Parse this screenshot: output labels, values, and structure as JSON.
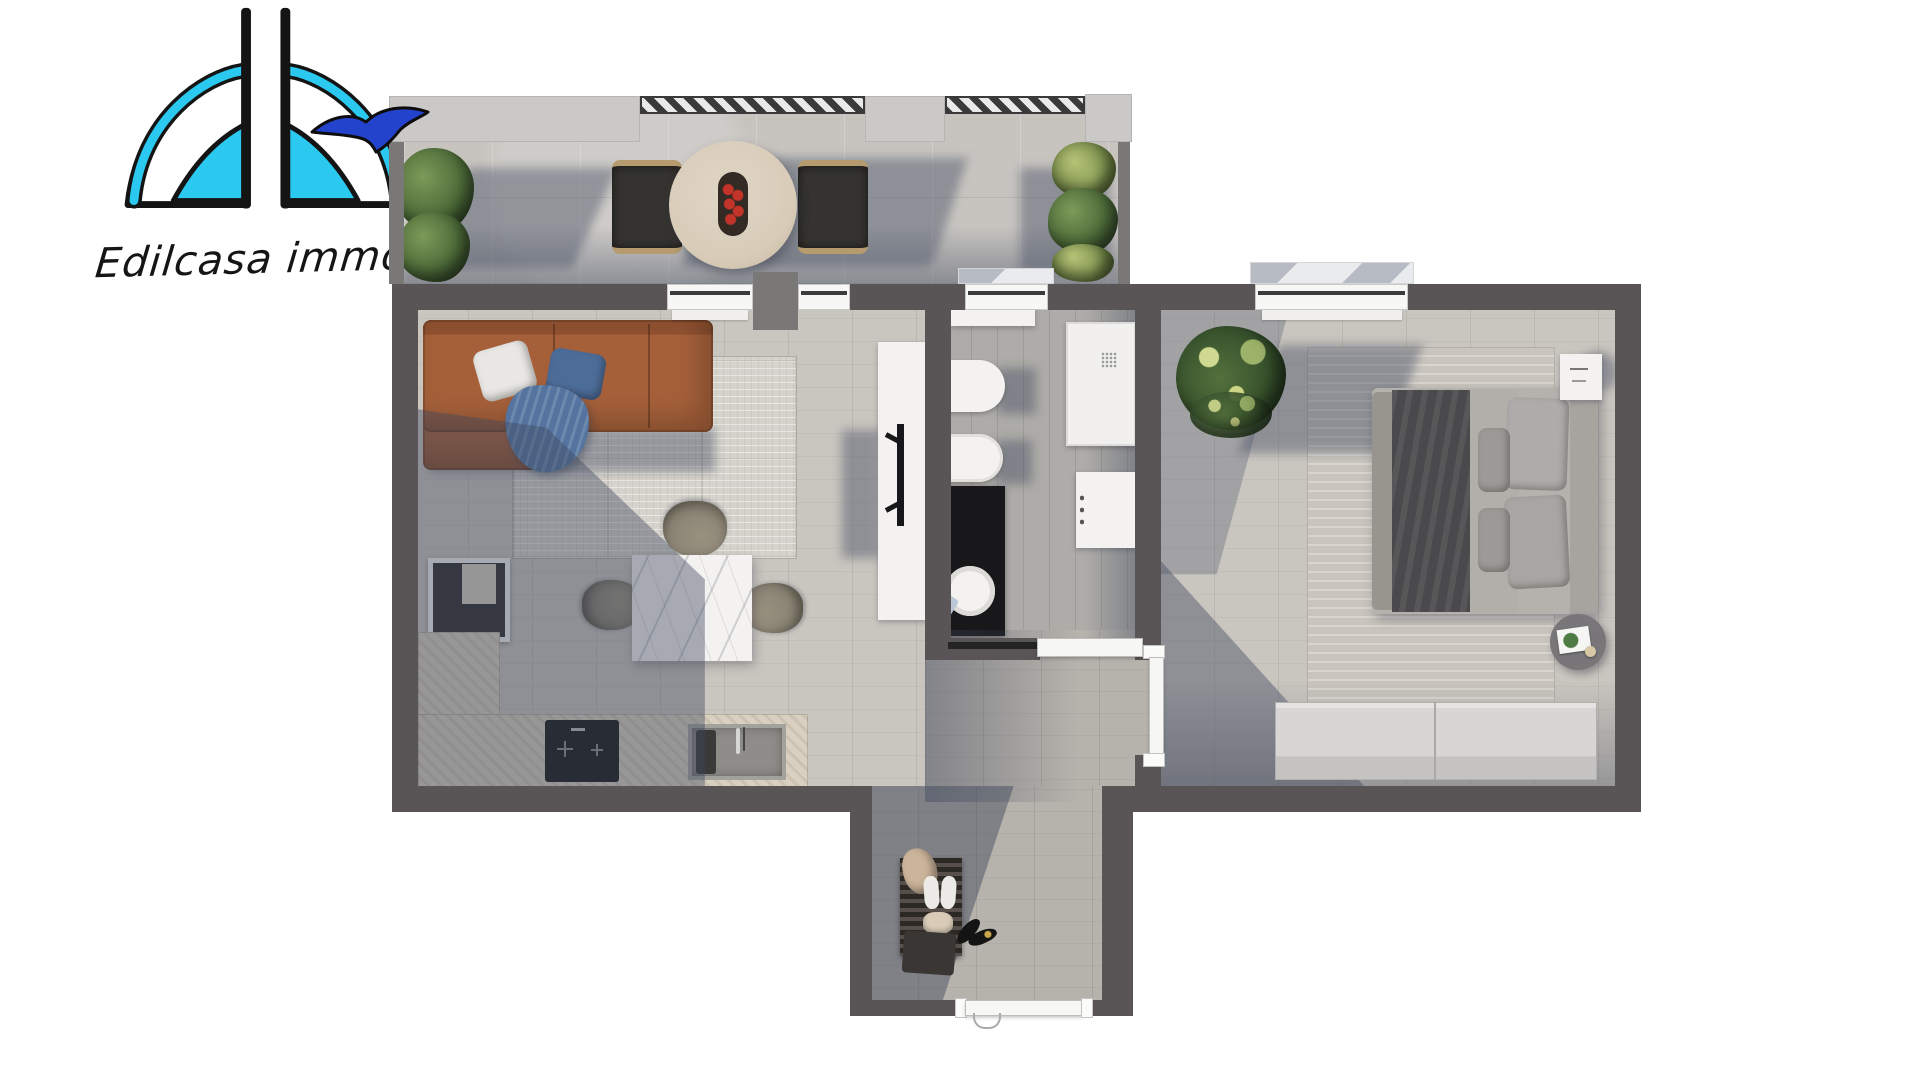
{
  "brand": {
    "name": "Edilcasa immobilia"
  },
  "theme": {
    "logo-cyan": "#2bc9f0",
    "logo-bird": "#2443cd",
    "ink": "#151515",
    "wall": "#595556",
    "wall-light": "#7a7876",
    "parapet": "#cbc9c7",
    "stone": "#c7c4c0",
    "wood": "#c9c5bf",
    "wood-mid": "#b6b2ac",
    "bath-floor": "#aeaca8",
    "shadow-blue": "rgba(62,71,92,0.42)",
    "rug": "#d6d3cc",
    "rug-bed": "#c9c5bd",
    "leather": "#a5603a",
    "pillow-blue": "#4d6d99",
    "throw-blue": "#54749f",
    "counter": "#d9d0c2",
    "cook": "#191919",
    "fixture": "#f3f2f0",
    "vanity": "#18181a",
    "duvet": "#4a4a4c",
    "sheet": "#b2afab",
    "apple": "#c23329",
    "chair-olive": "#8a8374",
    "table-wood": "#d8ccb9",
    "door": "#f6f6f5"
  },
  "floorplan": {
    "rooms": [
      {
        "id": "balcony"
      },
      {
        "id": "living-room-kitchen"
      },
      {
        "id": "bathroom"
      },
      {
        "id": "bedroom"
      },
      {
        "id": "entrance-hall"
      }
    ]
  }
}
